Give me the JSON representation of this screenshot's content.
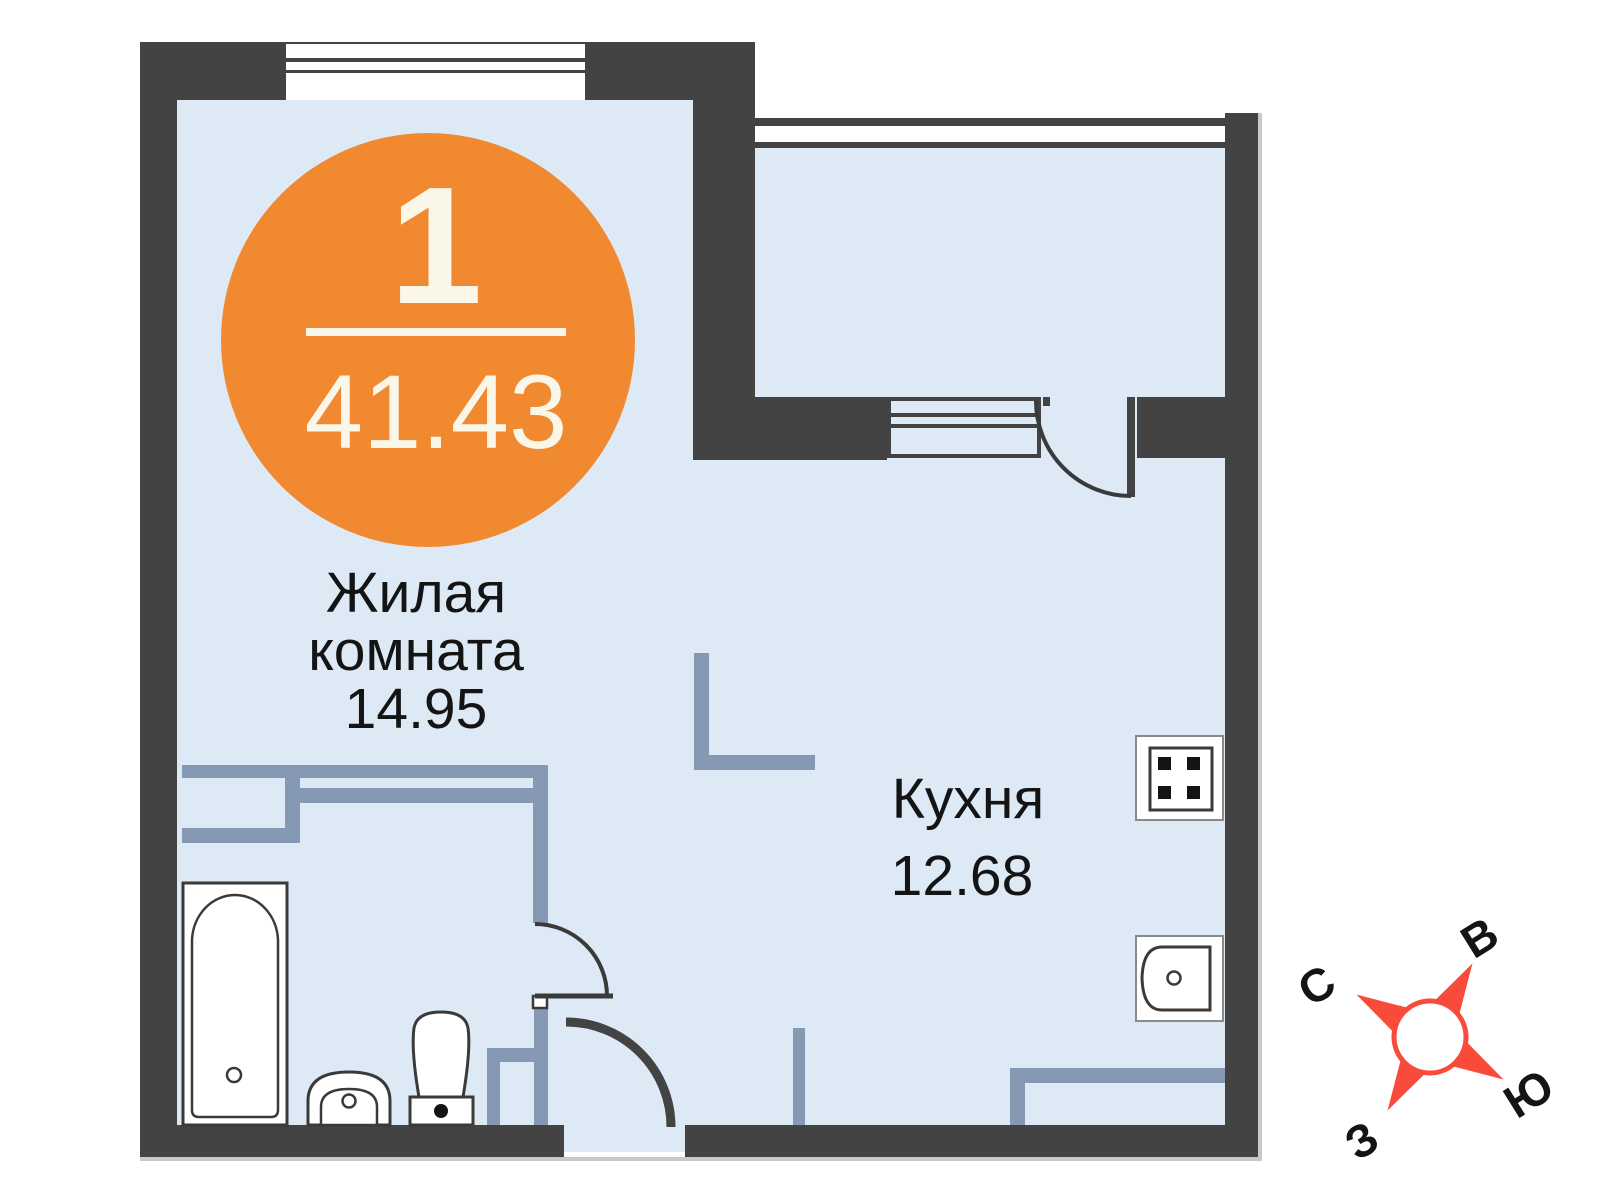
{
  "badge": {
    "room_count": "1",
    "total_area": "41.43"
  },
  "rooms": {
    "living": {
      "line1": "Жилая",
      "line2": "комната",
      "area": "14.95"
    },
    "kitchen": {
      "name": "Кухня",
      "area": "12.68"
    }
  },
  "compass": {
    "north": "С",
    "east": "В",
    "south": "Ю",
    "west": "З"
  },
  "icons": [
    "bathtub-icon",
    "bathroom-sink-icon",
    "toilet-icon",
    "stove-icon",
    "kitchen-sink-icon",
    "compass-rose",
    "window",
    "door-swing"
  ],
  "colors": {
    "wall": "#434343",
    "partition": "#8598b4",
    "room_fill": "#ddeaf6",
    "accent_orange": "#f0892f",
    "badge_text": "#faf6e8",
    "compass_red": "#f94b3b",
    "label_text": "#141414",
    "line": "#3a3a3a",
    "outer_edge": "#c9c9c9"
  }
}
